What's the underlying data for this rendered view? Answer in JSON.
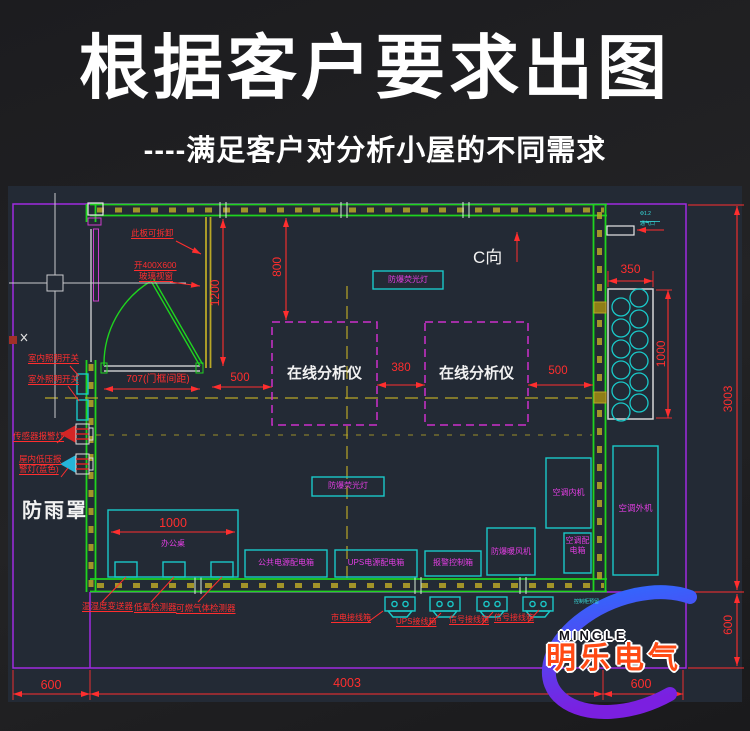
{
  "header": {
    "title": "根据客户要求出图",
    "subtitle": "----满足客户对分析小屋的不同需求"
  },
  "drawing": {
    "notes": {
      "panel_removable": "此板可拆卸",
      "window_open": "开400X600",
      "window_glass": "玻璃视窗",
      "direction": "C向",
      "rain_cover": "防雨罩",
      "vent_size": "Φ1.2",
      "vent_name": "通气口",
      "reserved": "控制柜预留"
    },
    "dims": {
      "left_panel_height": "1200",
      "top_clearance": "800",
      "door_frame": "707(门框间距)",
      "left_gap": "500",
      "between_analyzers": "380",
      "right_gap": "500",
      "cylinder_width": "350",
      "cylinder_height": "1000",
      "shelter_depth": "3003",
      "right_apron": "600",
      "desk_width": "1000",
      "left_apron": "600",
      "shelter_width": "4003",
      "right_apron_bottom": "600"
    },
    "equipment": {
      "analyzer_1": "在线分析仪",
      "analyzer_2": "在线分析仪",
      "fluorescent_1": "防爆荧光灯",
      "fluorescent_2": "防爆荧光灯",
      "desk": "办公桌",
      "public_power_box": "公共电源配电箱",
      "ups_power_box": "UPS电源配电箱",
      "alarm_control_box": "报警控制箱",
      "heater": "防爆暖风机",
      "ac_indoor": "空调内机",
      "ac_power_box": "空调配电箱",
      "ac_outdoor": "空调外机"
    },
    "callouts": {
      "indoor_light_switch": "室内照明开关",
      "outdoor_light_switch": "室外照明开关",
      "sensor_alarm_light": "传感器报警灯",
      "low_pressure_alarm": "屋内低压报警灯(蓝色)",
      "detector_temp_humidity": "温湿度变送器",
      "detector_low_oxygen": "低氧检测器",
      "detector_gas": "可燃气体检测器",
      "junction_mains": "市电接线箱",
      "junction_ups": "UPS接线箱",
      "junction_signal_1": "信号接线箱",
      "junction_signal_2": "信号接线箱"
    }
  },
  "watermark": {
    "brand_en": "MINGLE",
    "brand_cn": "明乐电气"
  },
  "colors": {
    "background": "#232a35",
    "wall_green": "#1fd41f",
    "boundary_purple": "#a02be0",
    "equipment_cyan": "#1ac8c8",
    "label_magenta": "#e23ee2",
    "dimension_red": "#ff2e2e",
    "centerline_yellow": "#b9a727",
    "swoosh_blue": "#2e6bff",
    "swoosh_purple": "#7b1fe0",
    "brand_orange": "#ff4a14"
  }
}
